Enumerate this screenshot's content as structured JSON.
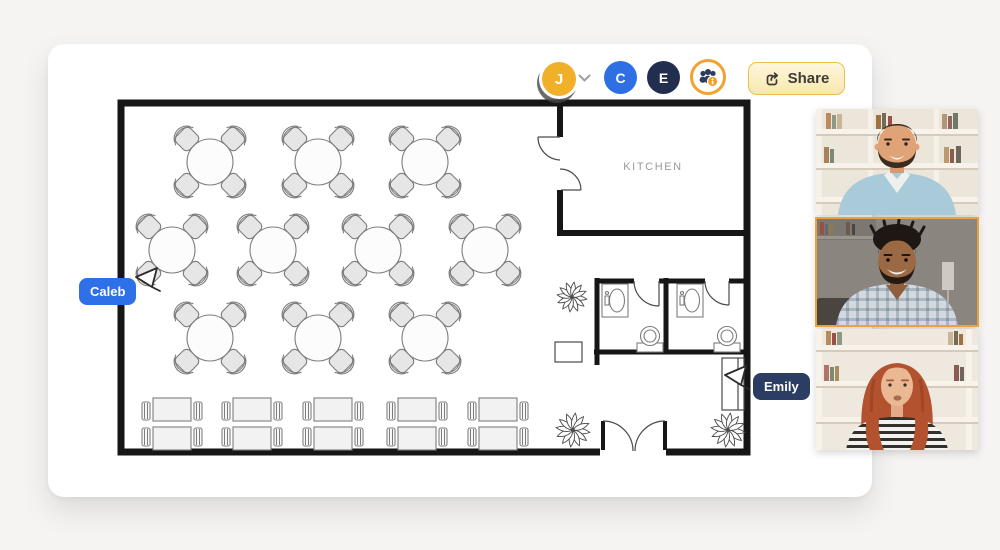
{
  "app": {
    "background": "#f5f4f2",
    "card_color": "#ffffff"
  },
  "toolbar": {
    "avatars": [
      {
        "initial": "J",
        "color": "#F1B02A",
        "selected": true
      },
      {
        "initial": "C",
        "color": "#2E6FE4",
        "selected": false
      },
      {
        "initial": "E",
        "color": "#212E4F",
        "selected": false
      }
    ],
    "dropdown_icon": "chevron-down",
    "collaborators_button": {
      "icon": "people-info",
      "accent": "#F0A32E"
    },
    "share_button": {
      "label": "Share",
      "icon": "share-arrow",
      "background": "#FBEFC2",
      "border": "#E9BE4B"
    }
  },
  "presence_cursors": [
    {
      "name": "Caleb",
      "color": "#2E70E8",
      "label_pos": [
        79,
        278
      ],
      "cursor_pos": [
        133,
        264
      ]
    },
    {
      "name": "Emily",
      "color": "#2B3D63",
      "label_pos": [
        753,
        373
      ],
      "cursor_pos": [
        722,
        362
      ]
    }
  ],
  "floorplan": {
    "kitchen_label": "KITCHEN",
    "round_tables": [
      [
        210,
        162
      ],
      [
        318,
        162
      ],
      [
        425,
        162
      ],
      [
        172,
        250
      ],
      [
        273,
        250
      ],
      [
        378,
        250
      ],
      [
        485,
        250
      ],
      [
        210,
        338
      ],
      [
        318,
        338
      ],
      [
        425,
        338
      ]
    ],
    "booth_tables": [
      [
        172,
        424
      ],
      [
        252,
        424
      ],
      [
        333,
        424
      ],
      [
        417,
        424
      ],
      [
        498,
        424
      ]
    ],
    "plants": [
      [
        572,
        297,
        15
      ],
      [
        573,
        430,
        17
      ],
      [
        728,
        430,
        17
      ]
    ],
    "sinks": [
      [
        602,
        284
      ],
      [
        677,
        284
      ]
    ],
    "toilets": [
      [
        650,
        336
      ],
      [
        727,
        336
      ]
    ]
  },
  "video_call": {
    "participants": [
      {
        "id": "participant-1",
        "description": "man with beard in light blue shirt",
        "active": false
      },
      {
        "id": "participant-2",
        "description": "smiling man in plaid shirt",
        "active": true,
        "highlight": "#E8A33D"
      },
      {
        "id": "participant-3",
        "description": "woman with red hair in striped top",
        "active": false
      }
    ]
  }
}
